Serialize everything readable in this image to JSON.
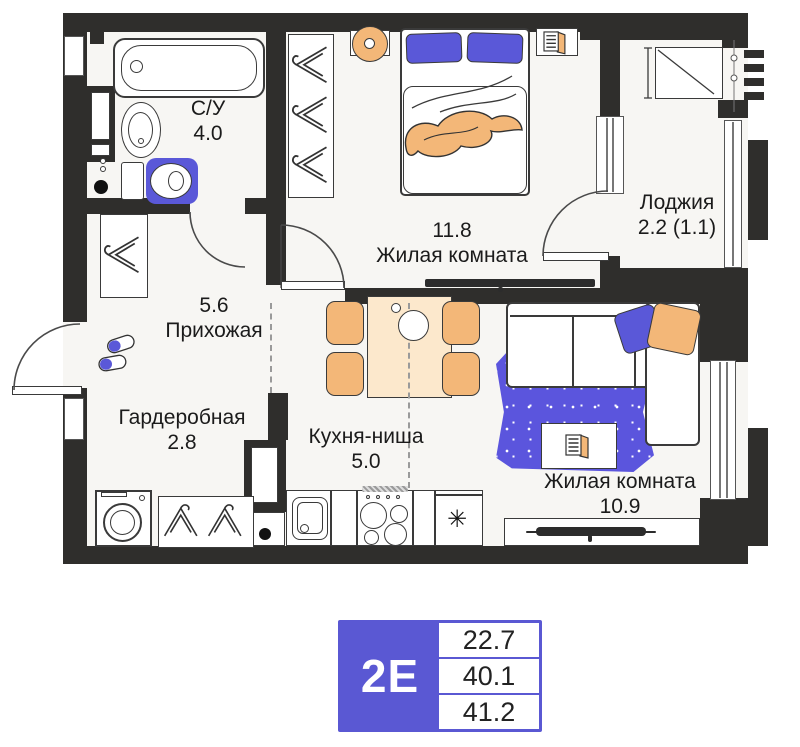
{
  "plan": {
    "rooms": [
      {
        "key": "bathroom",
        "name": "С/У",
        "area": "4.0"
      },
      {
        "key": "bedroom",
        "name": "Жилая комната",
        "area": "11.8"
      },
      {
        "key": "loggia",
        "name": "Лоджия",
        "area": "2.2 (1.1)"
      },
      {
        "key": "hallway",
        "name": "Прихожая",
        "area": "5.6"
      },
      {
        "key": "wardrobe",
        "name": "Гардеробная",
        "area": "2.8"
      },
      {
        "key": "kitchen",
        "name": "Кухня-ниша",
        "area": "5.0"
      },
      {
        "key": "living_room",
        "name": "Жилая комната",
        "area": "10.9"
      }
    ],
    "icons": {
      "fridge_snowflake": "✳"
    }
  },
  "legend": {
    "unit_type": "2Е",
    "values": [
      "22.7",
      "40.1",
      "41.2"
    ]
  },
  "colors": {
    "wall": "#2f2e2c",
    "accent_blue": "#5a58d8",
    "rug_blue": "#5b55dd",
    "accent_orange": "#f3b778",
    "table_cream": "#fce8cc",
    "badge_blue": "#5a58d3"
  }
}
